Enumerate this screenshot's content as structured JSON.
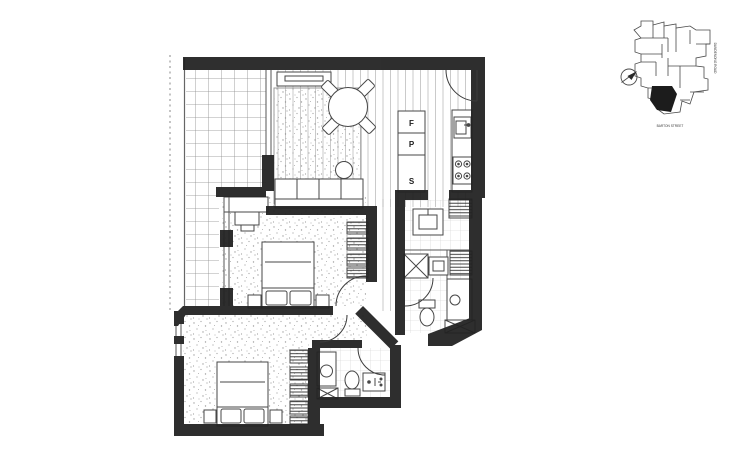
{
  "kitchen": {
    "fridge_label": "F",
    "pantry_label": "P",
    "storage_label": "S"
  },
  "key_plan": {
    "street_label": "BARTON STREET",
    "road_label": "DANDENONG ROAD"
  },
  "colors": {
    "wall": "#222222",
    "drawing_line": "#474747",
    "grid_line": "#8a8a8a",
    "paper": "#ffffff",
    "highlight_unit": "#1c1c1c"
  }
}
